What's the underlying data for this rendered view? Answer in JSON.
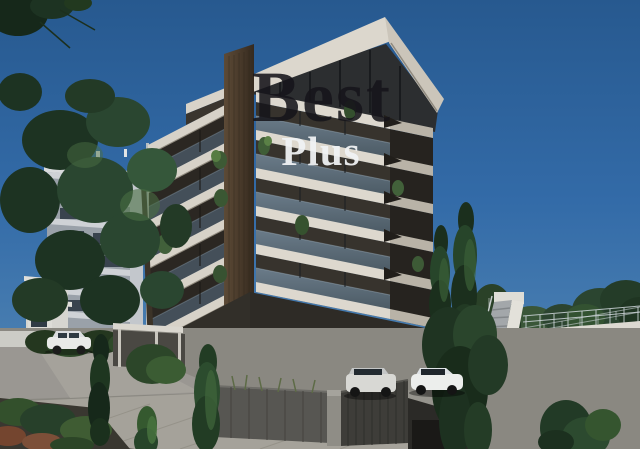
{
  "watermark": {
    "line1": "Best",
    "line2": "Plus"
  },
  "scene": {
    "type": "architectural-3d-render",
    "subject": "Modern multi-storey apartment building with stacked white balcony slabs, glass railings and bronze-wood facade",
    "elements": [
      "main-apartment-building",
      "left-grey-apartment-block",
      "right-white-villa-with-external-staircase",
      "two-tall-cypress-trees",
      "large-leafy-tree-left",
      "three-parked-white-cars",
      "street-sidewalk-and-boundary-walls",
      "hedges-and-planted-shrubs",
      "clear-deep-blue-sky"
    ]
  },
  "colors": {
    "sky_top": "#27598f",
    "sky_bottom": "#6f9cc2",
    "slab_white": "#d9d4ca",
    "slab_shadow": "#b9b3a7",
    "facade_bronze": "#37332d",
    "wood_column": "#4e3f2e",
    "glass_balustrade": "#5a6a78",
    "left_building_grey": "#9aa1a9",
    "villa_white": "#e6e3dc",
    "foliage_dark": "#1e3621",
    "foliage_light": "#4f7040",
    "road_grey": "#9a9792",
    "wall_dark": "#4a4a47",
    "watermark_dark": "#16141a",
    "watermark_light": "#f0f2f4"
  }
}
